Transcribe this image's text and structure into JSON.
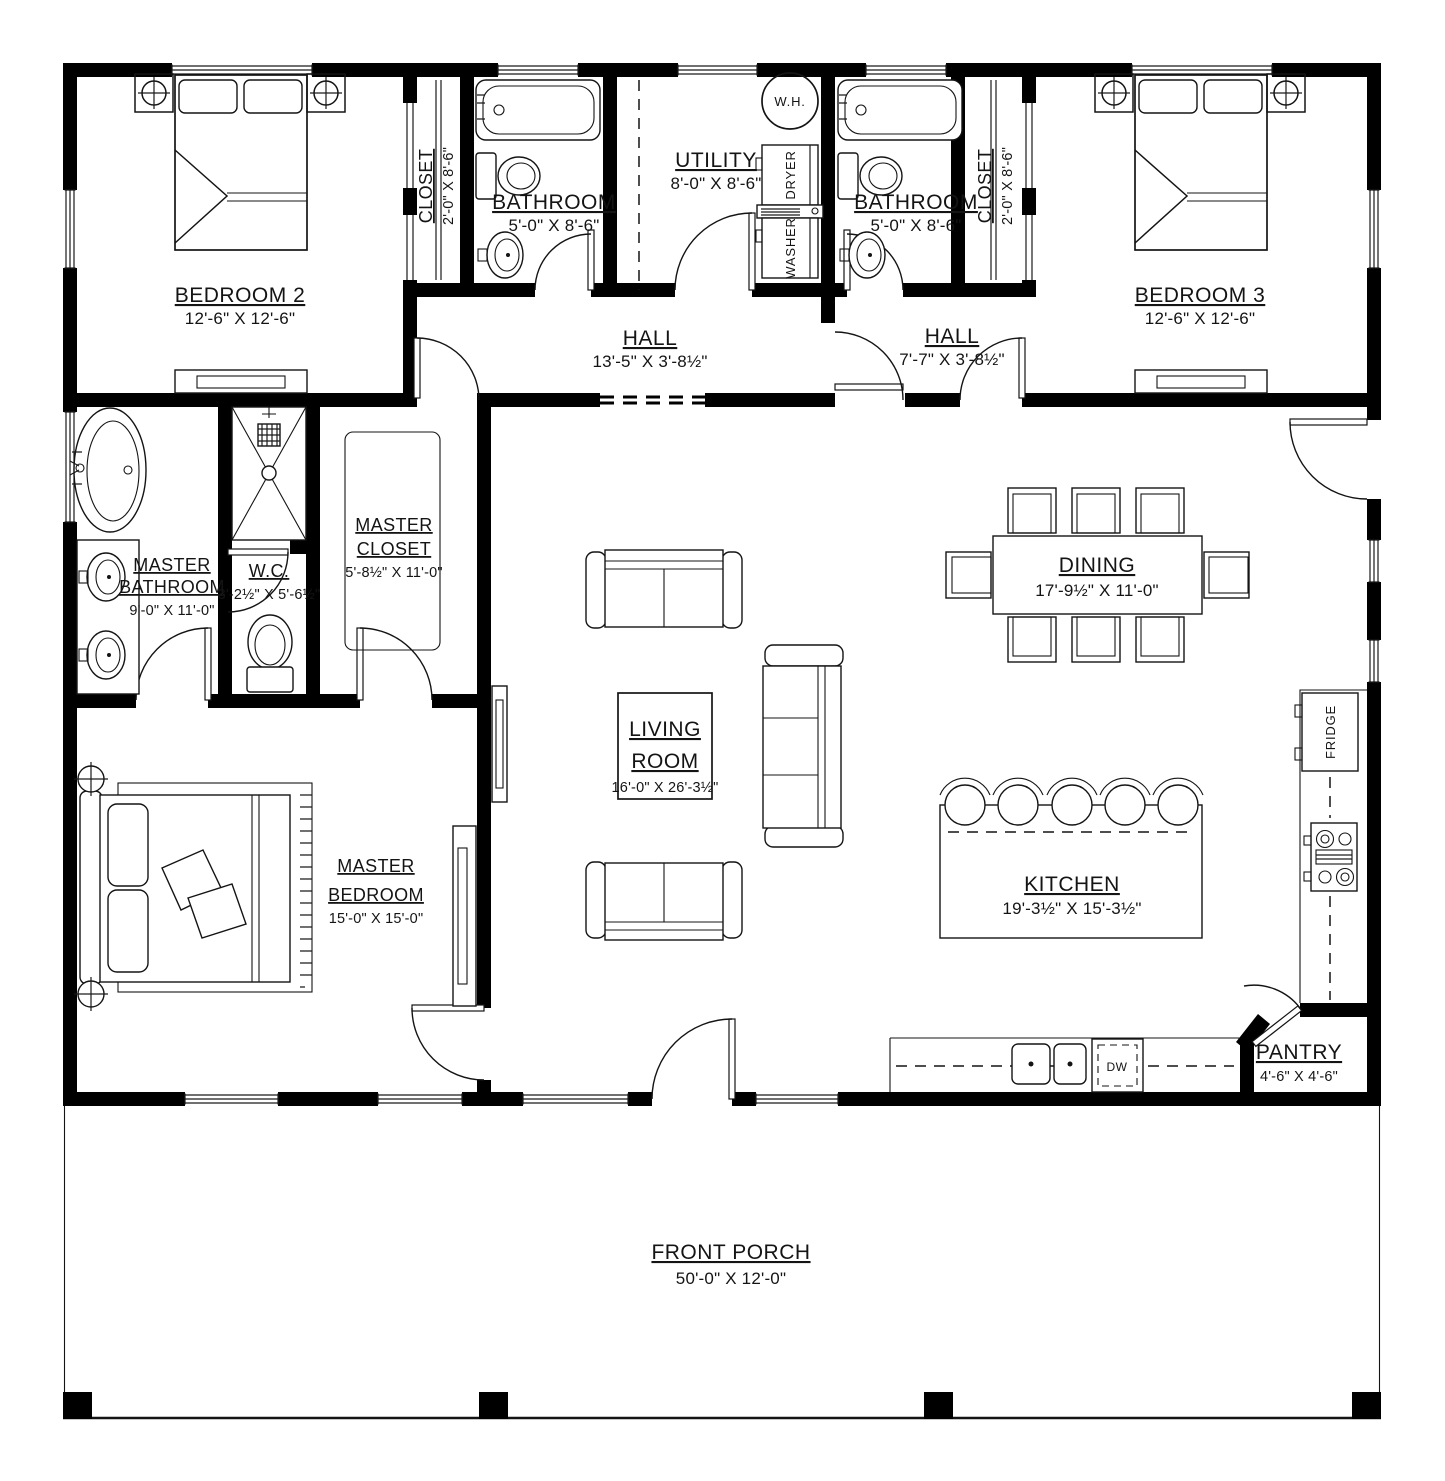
{
  "rooms": {
    "bedroom2": {
      "name": "BEDROOM 2",
      "dims": "12'-6\" X 12'-6\""
    },
    "bedroom3": {
      "name": "BEDROOM 3",
      "dims": "12'-6\" X 12'-6\""
    },
    "closet_left": {
      "name": "CLOSET",
      "dims": "2'-0\" X 8'-6\""
    },
    "closet_right": {
      "name": "CLOSET",
      "dims": "2'-0\" X 8'-6\""
    },
    "bathroom_left": {
      "name": "BATHROOM",
      "dims": "5'-0\" X 8'-6\""
    },
    "bathroom_right": {
      "name": "BATHROOM",
      "dims": "5'-0\" X 8'-6\""
    },
    "utility": {
      "name": "UTILITY",
      "dims": "8'-0\" X 8'-6\""
    },
    "hall_left": {
      "name": "HALL",
      "dims": "13'-5\" X 3'-8½\""
    },
    "hall_right": {
      "name": "HALL",
      "dims": "7'-7\" X 3'-8½\""
    },
    "master_bathroom": {
      "line1": "MASTER",
      "line2": "BATHROOM",
      "dims": "9'-0\" X 11'-0\""
    },
    "wc": {
      "name": "W.C.",
      "dims": "3'-2½\" X 5'-6½\""
    },
    "master_closet": {
      "line1": "MASTER",
      "line2": "CLOSET",
      "dims": "5'-8½\" X 11'-0\""
    },
    "living_room": {
      "line1": "LIVING",
      "line2": "ROOM",
      "dims": "16'-0\" X 26'-3½\""
    },
    "dining": {
      "name": "DINING",
      "dims": "17'-9½\" X 11'-0\""
    },
    "kitchen": {
      "name": "KITCHEN",
      "dims": "19'-3½\" X 15'-3½\""
    },
    "master_bedroom": {
      "line1": "MASTER",
      "line2": "BEDROOM",
      "dims": "15'-0\" X 15'-0\""
    },
    "pantry": {
      "name": "PANTRY",
      "dims": "4'-6\" X 4'-6\""
    },
    "front_porch": {
      "name": "FRONT PORCH",
      "dims": "50'-0\" X 12'-0\""
    }
  },
  "appliances": {
    "water_heater": "W.H.",
    "dryer": "DRYER",
    "washer": "WASHER",
    "fridge": "FRIDGE",
    "dishwasher": "DW"
  },
  "colors": {
    "wall": "#000000",
    "line": "#141414",
    "background": "#ffffff"
  }
}
